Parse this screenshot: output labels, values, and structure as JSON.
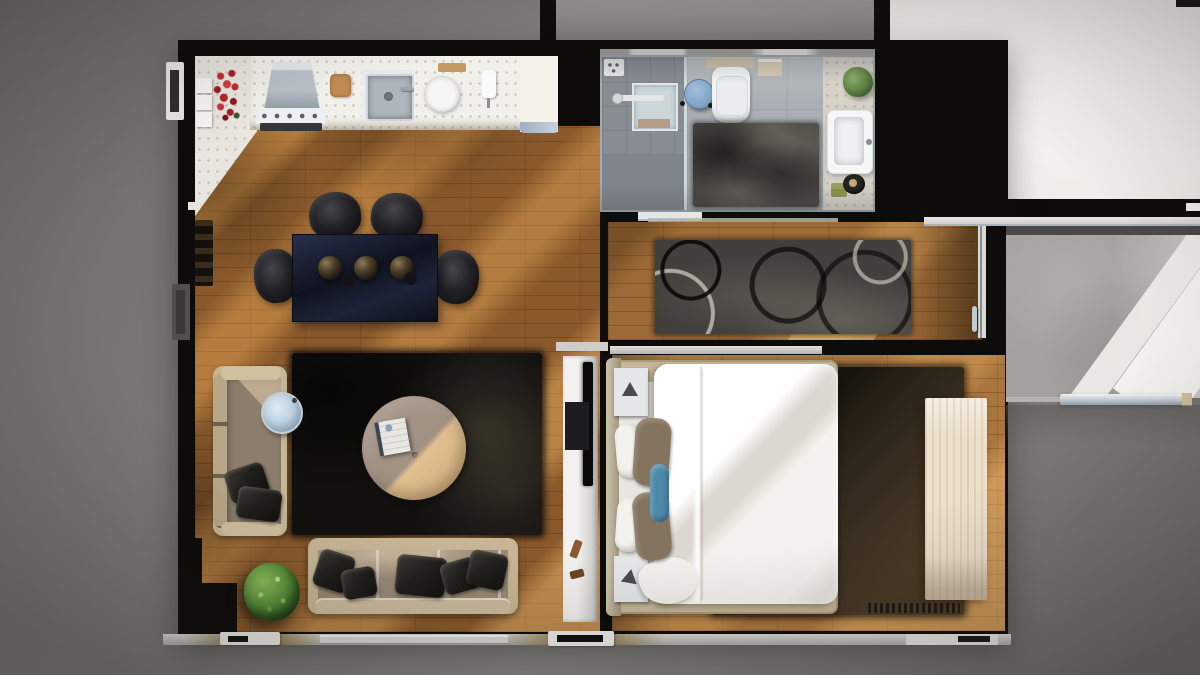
{
  "scene": {
    "title": "3D rendered one-bedroom apartment floor plan, top-down view",
    "type": "architectural-render",
    "style": "photoreal top-down dollhouse render on gray studio background, sunlight falling in diagonal bands across wood floors",
    "rooms": [
      {
        "name": "kitchen",
        "position": "top-left",
        "objects": [
          "white-speckled-counter",
          "shelf-boxes",
          "red-rose-bouquet",
          "stainless-range-hood",
          "cooktop-with-knobs",
          "oven-front",
          "wooden-cutting-board",
          "steel-sink",
          "faucet",
          "white-plate",
          "wooden-tray",
          "paper-towel-holder",
          "end-cabinet",
          "wine-rack"
        ]
      },
      {
        "name": "living-room",
        "position": "center-left",
        "objects": [
          "navy-glass-dining-table",
          "serving-bowls",
          "black-dining-chair-top-1",
          "black-dining-chair-top-2",
          "black-dining-chair-left",
          "black-dining-chair-right",
          "beige-left-sofa",
          "black-throw-pillows",
          "blue-glass-side-table",
          "black-shag-rug",
          "round-leather-ottoman",
          "open-book",
          "beige-bottom-sofa",
          "potted-plant",
          "tv-console",
          "flatscreen-tv",
          "media-box",
          "wood-decor"
        ]
      },
      {
        "name": "bathroom",
        "position": "top-center",
        "objects": [
          "walk-in-shower",
          "shower-tray",
          "bath-mat",
          "shower-control-panel",
          "glass-partition",
          "blue-round-stool",
          "toilet",
          "wall-cabinet",
          "gray-shag-rug",
          "green-plant",
          "white-bathtub",
          "green-towels",
          "black-accessory-tray"
        ]
      },
      {
        "name": "hallway",
        "position": "center-right",
        "objects": [
          "swirl-pattern-runner-rug",
          "balcony-door",
          "door-handle",
          "sunlight-patch"
        ]
      },
      {
        "name": "bedroom",
        "position": "bottom-right",
        "objects": [
          "double-bed",
          "headboard",
          "mattress",
          "white-duvet",
          "white-pillows",
          "brown-pillows",
          "blue-bolster-pillow",
          "nightstand-top",
          "nightstand-bottom",
          "tripod-lamp-top",
          "tripod-lamp-bottom",
          "brown-shag-rug",
          "rug-fringe",
          "cream-wardrobe",
          "sliding-door-track"
        ]
      },
      {
        "name": "balcony",
        "position": "right",
        "objects": [
          "concrete-floor",
          "roller-blind-bar",
          "metal-railing",
          "white-light-beams"
        ]
      },
      {
        "name": "bright-white-room",
        "position": "top-right",
        "objects": [
          "overexposed-empty-floor"
        ]
      },
      {
        "name": "neighbor-room",
        "position": "top-center-edge",
        "objects": [
          "gray-floor-sliver"
        ]
      },
      {
        "name": "exterior",
        "position": "edges",
        "objects": [
          "left-window-frame",
          "left-vent-block",
          "bottom-window-sills",
          "bottom-window-frames"
        ]
      }
    ],
    "palette": {
      "background_gray": "#7d7b79",
      "walls_black": "#0d0c0b",
      "wood_living": "#8a5a2c",
      "wood_hall": "#9c6a36",
      "wood_bedroom": "#a9763f",
      "sunlight": "#ffc373",
      "kitchen_counter": "#f2f0ea",
      "bath_floor": "#a9afb4",
      "bath_rug": "#4a4742",
      "runner_rug": "#41403c",
      "living_rug": "#121110",
      "bedroom_rug": "#352c1f",
      "sofa_frame": "#c6b695",
      "sofa_seat": "#8c7e6d",
      "ottoman_lit": "#e0be8e",
      "ottoman_shade": "#a29284",
      "dining_table_navy": "#1a2236",
      "chair_black": "#1a1a1d",
      "duvet_white": "#f6f4f0",
      "bolster_blue": "#4d8aa9",
      "stool_blue": "#86a9ca",
      "towel_green": "#9aa058",
      "plant_green": "#59913a",
      "white_room": "#f4f2ee",
      "balcony_concrete": "#a3a09d",
      "wardrobe_cream": "#ece0cb",
      "rose_red": "#c62b30"
    }
  }
}
